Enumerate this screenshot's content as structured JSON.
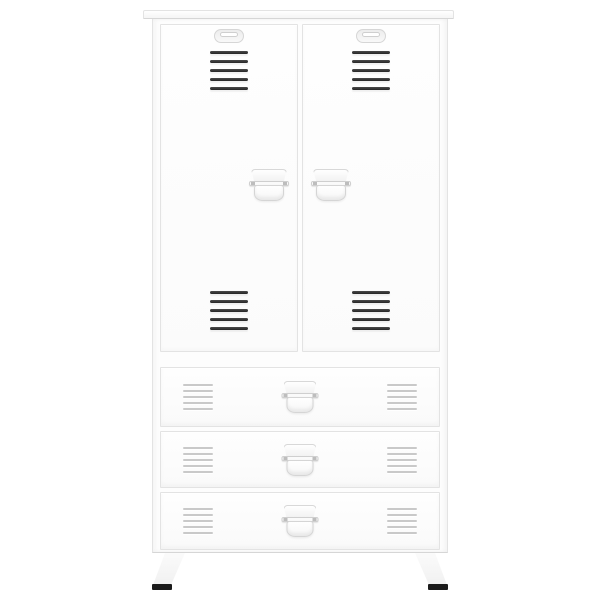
{
  "image": {
    "kind": "product-photo",
    "subject": "White industrial metal wardrobe cabinet with two vented doors, three vented drawers, latch handles and splayed legs with black feet",
    "visible_text": ""
  },
  "colors": {
    "bg": "#ffffff",
    "face": "#fdfdfd",
    "line": "#e3e3e3",
    "line_strong": "#d6d6d6",
    "vent_dark_a": "#4a4a4a",
    "vent_dark_b": "#262626",
    "vent_light": "#c9c9c9",
    "handle_edge": "#d8d8d8",
    "foot": "#1b1b1b"
  },
  "structure": {
    "doors": {
      "count": 2,
      "vent_groups_per_door": 2,
      "slats_per_vent": 5,
      "emblems": 2,
      "handle_style": "latch-pull"
    },
    "drawers": {
      "count": 3,
      "vent_groups_per_drawer": 2,
      "slats_per_vent": 5,
      "handle_style": "latch-pull"
    },
    "legs": {
      "count": 2,
      "foot_style": "black-cap"
    }
  }
}
